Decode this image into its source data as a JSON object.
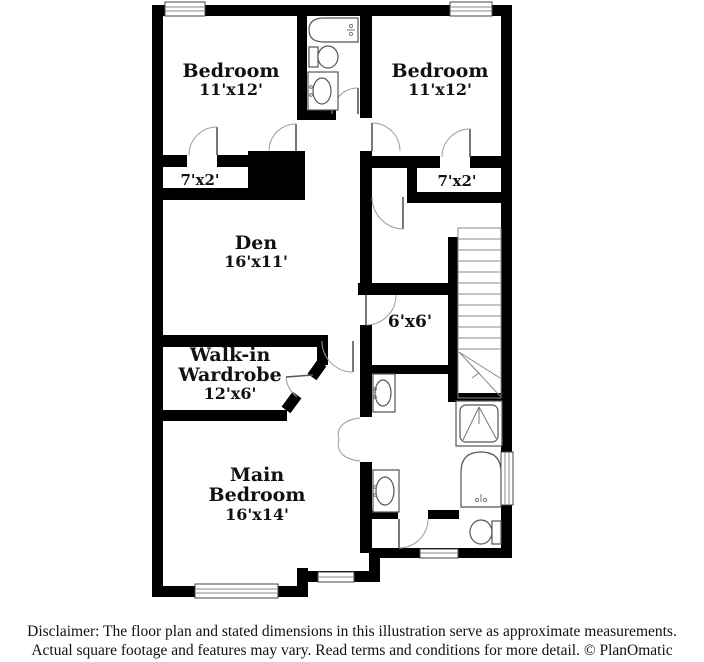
{
  "plan": {
    "rooms": {
      "bedroom_left": {
        "name": "Bedroom",
        "dims": "11'x12'"
      },
      "bedroom_right": {
        "name": "Bedroom",
        "dims": "11'x12'"
      },
      "den": {
        "name": "Den",
        "dims": "16'x11'"
      },
      "closet_left": {
        "dims": "7'x2'"
      },
      "closet_right": {
        "dims": "7'x2'"
      },
      "hall": {
        "dims": "6'x6'"
      },
      "wardrobe": {
        "name_line1": "Walk-in",
        "name_line2": "Wardrobe",
        "dims": "12'x6'"
      },
      "main_bedroom": {
        "name_line1": "Main",
        "name_line2": "Bedroom",
        "dims": "16'x14'"
      }
    },
    "colors": {
      "wall": "#000000",
      "fixture_line": "#666666",
      "background": "#ffffff"
    }
  },
  "footer": {
    "line1": "Disclaimer: The floor plan and stated dimensions in this illustration serve as approximate measurements.",
    "line2": "Actual square footage and features may vary. Read terms and conditions for more detail. © PlanOmatic"
  }
}
